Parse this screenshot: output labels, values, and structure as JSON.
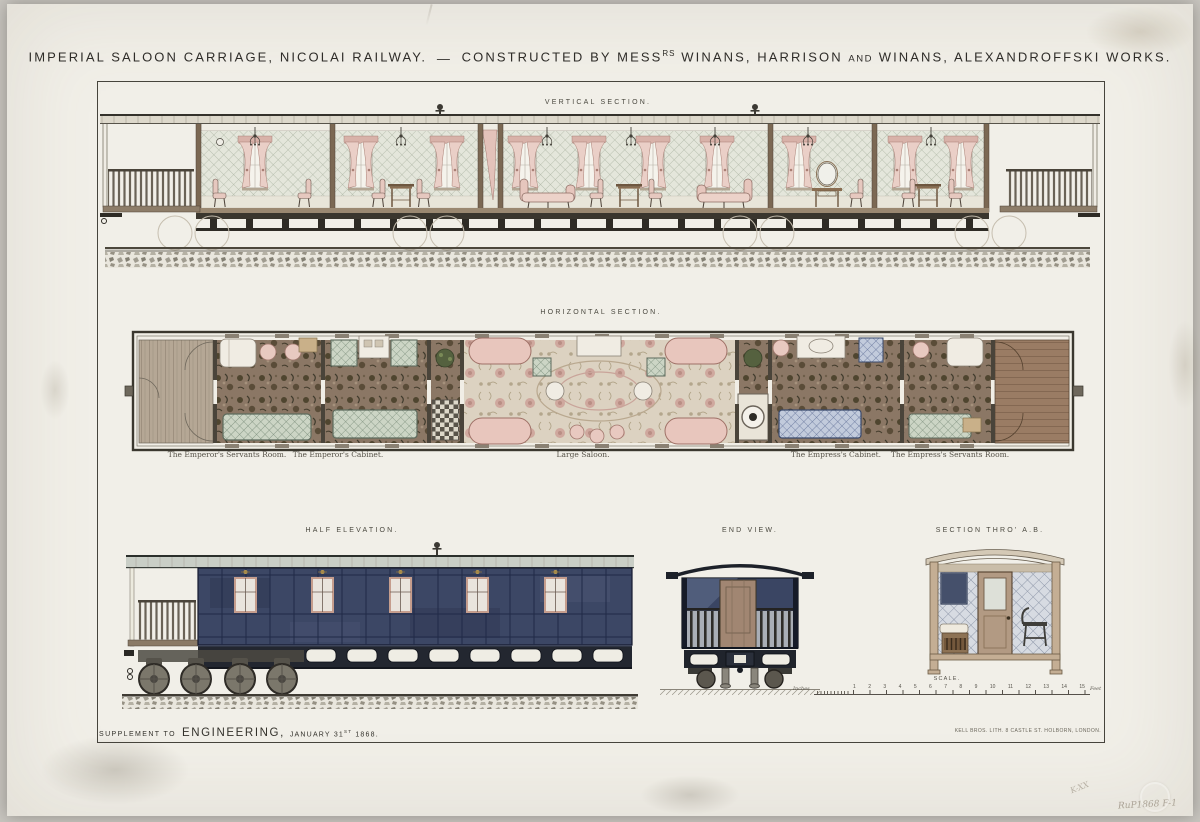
{
  "plate": {
    "title": {
      "part1": "IMPERIAL SALOON CARRIAGE, NICOLAI RAILWAY.",
      "dash": "—",
      "constructed_pre": "CONSTRUCTED BY MESS",
      "constructed_sup": "RS",
      "names_mid": "WINANS, HARRISON",
      "and_word": "AND",
      "names_end": "WINANS, ALEXANDROFFSKI WORKS."
    },
    "section_labels": {
      "vertical": "VERTICAL SECTION.",
      "horizontal": "HORIZONTAL SECTION.",
      "half_elevation": "HALF ELEVATION.",
      "end_view": "END VIEW.",
      "section_ab": "SECTION THRO' A.B."
    },
    "room_labels": [
      {
        "label": "The Emperor's Servants Room."
      },
      {
        "label": "The Emperor's Cabinet."
      },
      {
        "label": "Large Saloon."
      },
      {
        "label": "The Empress's Cabinet."
      },
      {
        "label": "The Empress's Servants Room."
      }
    ],
    "scale_bar": {
      "title": "SCALE.",
      "left_unit": "Inches",
      "right_unit": "Feet",
      "ticks": [
        "1",
        "2",
        "3",
        "4",
        "5",
        "6",
        "7",
        "8",
        "9",
        "10",
        "11",
        "12",
        "13",
        "14",
        "15"
      ]
    },
    "imprint": {
      "supplement": "SUPPLEMENT TO",
      "journal": "ENGINEERING,",
      "date_main": "JANUARY 31",
      "date_sup": "ST",
      "date_year": "1868.",
      "printer": "KELL BROS. LITH. 8 CASTLE ST. HOLBORN, LONDON."
    },
    "pencil_annotations": {
      "mark1": "K-XX",
      "mark2": "RuP1868 F-1"
    },
    "colors": {
      "paper": "#f1efe8",
      "backdrop": "#c9c6c0",
      "ink": "#2f2d28",
      "body_navy": "#3c4765",
      "upholstery_pink": "#e6c6bd",
      "quilt_green": "#ccd5c5",
      "quilt_blue": "#c2cbdc",
      "carpet_brown": "#8b7765"
    }
  }
}
